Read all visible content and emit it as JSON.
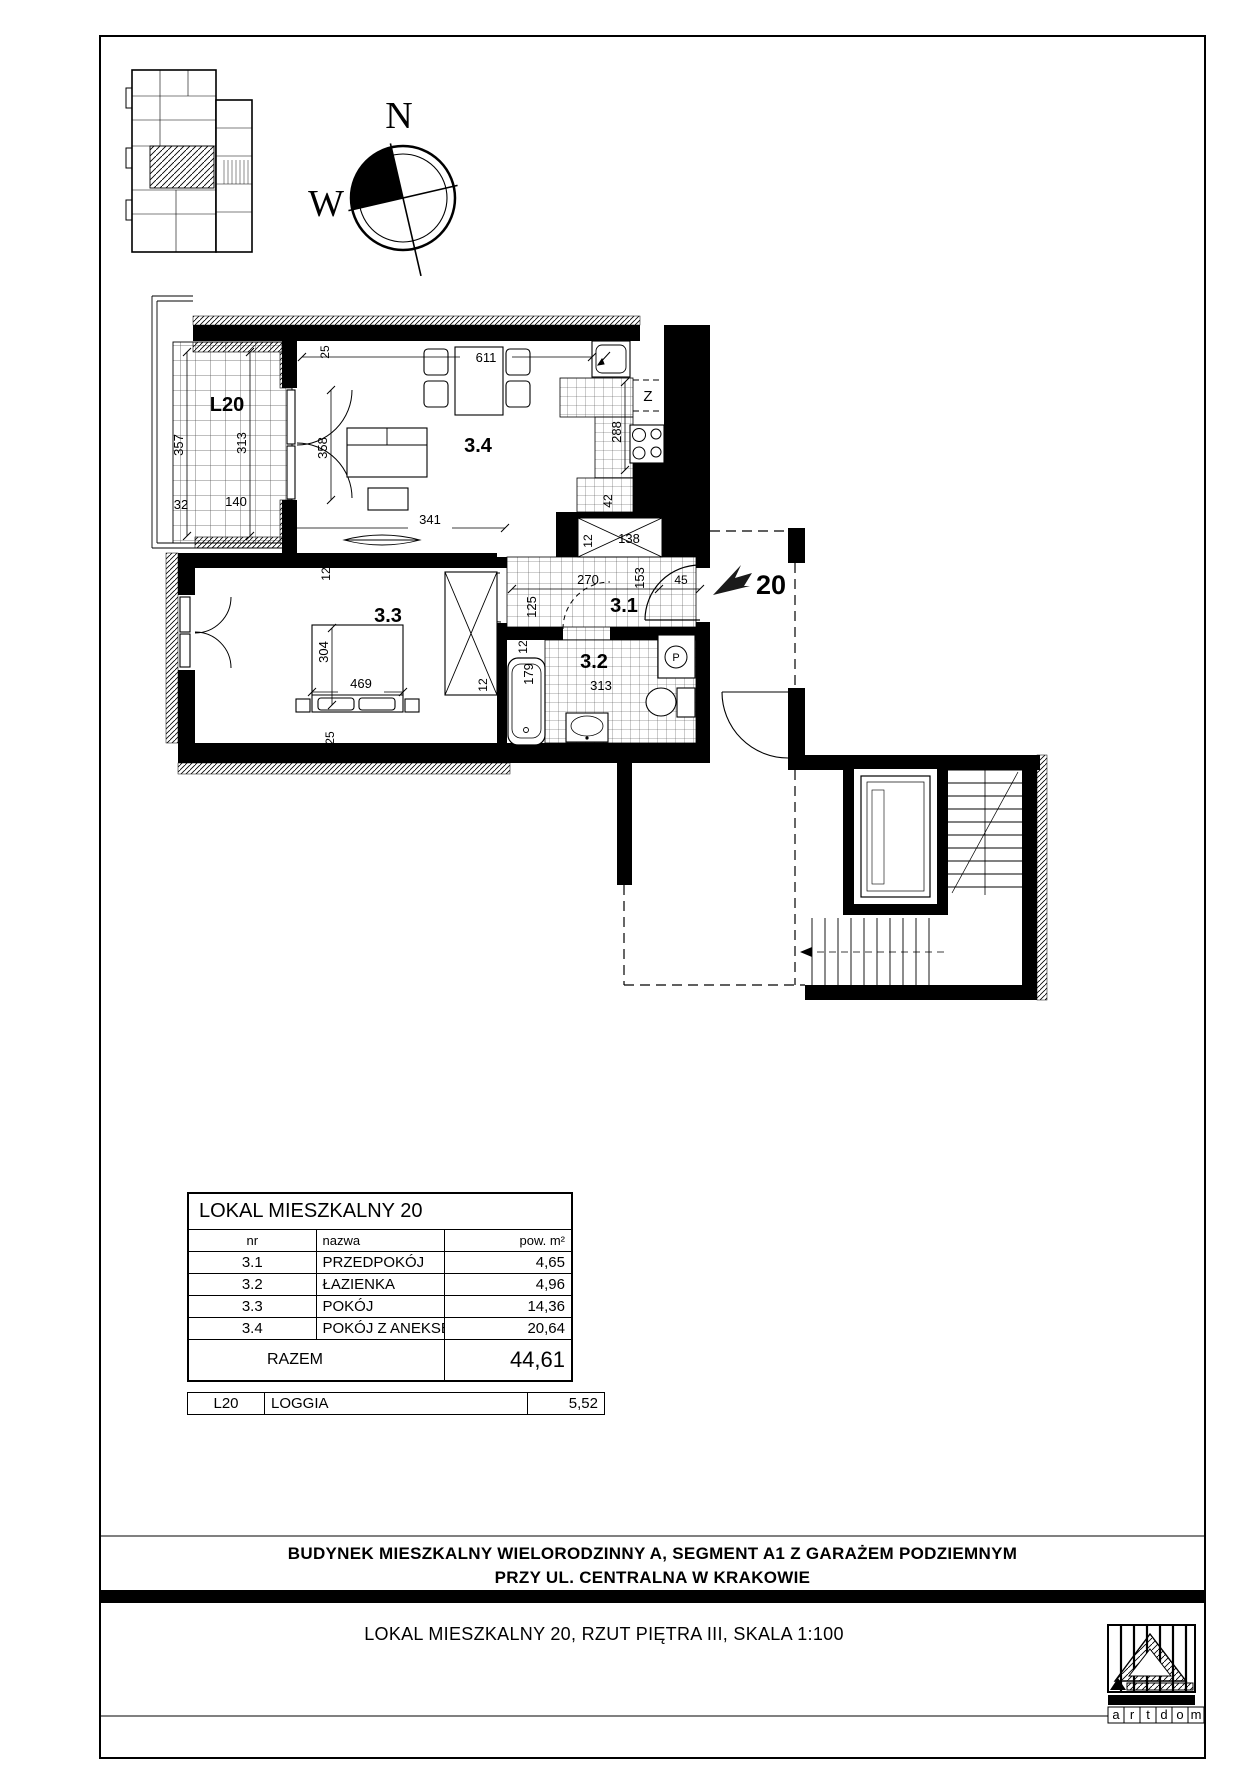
{
  "compass": {
    "north": "N",
    "west": "W"
  },
  "marker": {
    "unit": "20"
  },
  "rooms": {
    "loggia": "L20",
    "hall": "3.1",
    "bath": "3.2",
    "bedroom": "3.3",
    "living": "3.4"
  },
  "fixtures": {
    "fridge": "Z",
    "washer": "P"
  },
  "dims": {
    "d611": "611",
    "d341": "341",
    "d357": "357",
    "d313a": "313",
    "d358": "358",
    "d32": "32",
    "d140": "140",
    "d25a": "25",
    "d25b": "25",
    "d288": "288",
    "d42": "42",
    "d12a": "12",
    "d12c": "12",
    "d12d": "12",
    "d12e": "12",
    "d138": "138",
    "d270": "270",
    "d125": "125",
    "d153": "153",
    "d45": "45",
    "d179": "179",
    "d313b": "313",
    "d304": "304",
    "d469": "469"
  },
  "table": {
    "title": "LOKAL MIESZKALNY 20",
    "columns": {
      "nr": "nr",
      "nazwa": "nazwa",
      "pow": "pow. m²"
    },
    "rows": [
      {
        "nr": "3.1",
        "nazwa": "PRZEDPOKÓJ",
        "pow": "4,65"
      },
      {
        "nr": "3.2",
        "nazwa": "ŁAZIENKA",
        "pow": "4,96"
      },
      {
        "nr": "3.3",
        "nazwa": "POKÓJ",
        "pow": "14,36"
      },
      {
        "nr": "3.4",
        "nazwa": "POKÓJ Z ANEKSEM KUCH.",
        "pow": "20,64"
      }
    ],
    "total": {
      "label": "RAZEM",
      "value": "44,61"
    },
    "loggia_row": {
      "nr": "L20",
      "nazwa": "LOGGIA",
      "pow": "5,52"
    }
  },
  "footer": {
    "building_line1": "BUDYNEK MIESZKALNY WIELORODZINNY A, SEGMENT A1 Z GARAŻEM PODZIEMNYM",
    "building_line2": "PRZY UL. CENTRALNA W KRAKOWIE",
    "drawing_title": "LOKAL MIESZKALNY 20, RZUT PIĘTRA III, SKALA 1:100"
  },
  "logo": {
    "letters": [
      "a",
      "r",
      "t",
      "d",
      "o",
      "m"
    ]
  }
}
